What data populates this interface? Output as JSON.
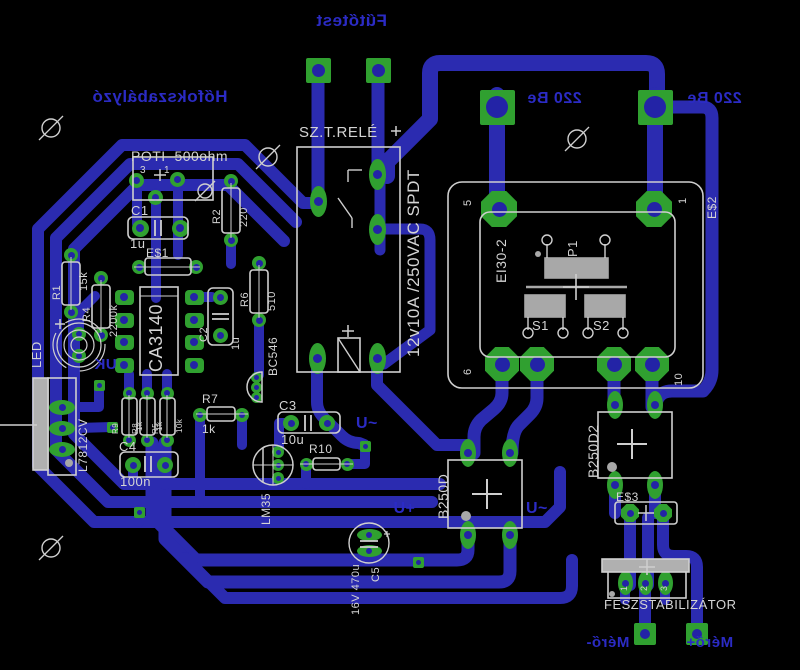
{
  "board": {
    "background": "#000000",
    "trace_color": "#2b2bb0",
    "pad_color": "#30a030",
    "silk_color": "#cfcfcf",
    "copper_text_color": "#2b2bc4"
  },
  "copper_texts": [
    {
      "name": "label-futotest",
      "text": "Fűtőtest",
      "x": 316,
      "y": 12,
      "size": 17,
      "mirrored": true
    },
    {
      "name": "label-hofokszabalyzo",
      "text": "Hőfokszabályzó",
      "x": 92,
      "y": 88,
      "size": 17,
      "mirrored": true
    },
    {
      "name": "label-220be-left",
      "text": "220 Be",
      "x": 527,
      "y": 91,
      "size": 16,
      "mirrored": true
    },
    {
      "name": "label-220be-right",
      "text": "220 Be",
      "x": 687,
      "y": 91,
      "size": 16,
      "mirrored": true
    },
    {
      "name": "label-uk",
      "text": "UK",
      "x": 94,
      "y": 357,
      "size": 15,
      "mirrored": true
    },
    {
      "name": "label-u-ac-top",
      "text": "U~",
      "x": 356,
      "y": 416,
      "size": 16,
      "mirrored": false
    },
    {
      "name": "label-u-plus",
      "text": "+U",
      "x": 393,
      "y": 501,
      "size": 16,
      "mirrored": true
    },
    {
      "name": "label-u-ac-right",
      "text": "U~",
      "x": 526,
      "y": 501,
      "size": 16,
      "mirrored": false
    },
    {
      "name": "label-mero-minus",
      "text": "Mérő-",
      "x": 586,
      "y": 635,
      "size": 15,
      "mirrored": true
    },
    {
      "name": "label-mero-plus",
      "text": "Mérő+",
      "x": 686,
      "y": 635,
      "size": 15,
      "mirrored": true
    }
  ],
  "silk_texts": [
    {
      "name": "label-relay",
      "text": "SZ.T.RELÉ",
      "x": 299,
      "y": 125,
      "size": 15,
      "rot": 0
    },
    {
      "name": "label-relay-rating",
      "text": "12v10A /250VAC SPDT",
      "x": 405,
      "y": 357,
      "size": 17,
      "rot": -90
    },
    {
      "name": "label-poti",
      "text": "POTI  500ohm",
      "x": 131,
      "y": 149,
      "size": 14,
      "rot": 0
    },
    {
      "name": "label-c1",
      "text": "C1",
      "x": 131,
      "y": 204,
      "size": 13,
      "rot": 0
    },
    {
      "name": "value-c1",
      "text": "1u",
      "x": 130,
      "y": 237,
      "size": 13,
      "rot": 0
    },
    {
      "name": "label-e1",
      "text": "E$1",
      "x": 146,
      "y": 247,
      "size": 12,
      "rot": 0
    },
    {
      "name": "label-r2",
      "text": "R2",
      "x": 212,
      "y": 224,
      "size": 11,
      "rot": -90
    },
    {
      "name": "value-r2",
      "text": "220",
      "x": 239,
      "y": 227,
      "size": 11,
      "rot": -90
    },
    {
      "name": "label-r1",
      "text": "R1",
      "x": 52,
      "y": 300,
      "size": 11,
      "rot": -90
    },
    {
      "name": "value-r1",
      "text": "15k",
      "x": 79,
      "y": 291,
      "size": 11,
      "rot": -90
    },
    {
      "name": "label-r4",
      "text": "R4",
      "x": 82,
      "y": 322,
      "size": 11,
      "rot": -90
    },
    {
      "name": "value-r4",
      "text": "2200k",
      "x": 109,
      "y": 337,
      "size": 11,
      "rot": -90
    },
    {
      "name": "label-ic",
      "text": "CA3140",
      "x": 147,
      "y": 372,
      "size": 18,
      "rot": -90
    },
    {
      "name": "label-c2",
      "text": "C2",
      "x": 199,
      "y": 342,
      "size": 11,
      "rot": -90
    },
    {
      "name": "value-c2",
      "text": "1u",
      "x": 231,
      "y": 350,
      "size": 11,
      "rot": -90
    },
    {
      "name": "label-r6",
      "text": "R6",
      "x": 240,
      "y": 307,
      "size": 11,
      "rot": -90
    },
    {
      "name": "value-r6",
      "text": "510",
      "x": 267,
      "y": 311,
      "size": 11,
      "rot": -90
    },
    {
      "name": "label-bc546",
      "text": "BC546",
      "x": 267,
      "y": 376,
      "size": 12,
      "rot": -90
    },
    {
      "name": "label-led",
      "text": "LED",
      "x": 30,
      "y": 368,
      "size": 13,
      "rot": -90
    },
    {
      "name": "label-7812",
      "text": "L7812CV",
      "x": 77,
      "y": 472,
      "size": 12,
      "rot": -90
    },
    {
      "name": "label-r9",
      "text": "R9",
      "x": 112,
      "y": 434,
      "size": 8,
      "rot": -90
    },
    {
      "name": "value-r9",
      "text": "1k",
      "x": 136,
      "y": 431,
      "size": 8,
      "rot": -90
    },
    {
      "name": "label-r8",
      "text": "R8",
      "x": 132,
      "y": 434,
      "size": 8,
      "rot": -90
    },
    {
      "name": "value-r8",
      "text": "1k",
      "x": 156,
      "y": 431,
      "size": 8,
      "rot": -90
    },
    {
      "name": "label-r5",
      "text": "R5",
      "x": 152,
      "y": 434,
      "size": 8,
      "rot": -90
    },
    {
      "name": "value-r5",
      "text": "10k",
      "x": 176,
      "y": 433,
      "size": 8,
      "rot": -90
    },
    {
      "name": "label-r7",
      "text": "R7",
      "x": 202,
      "y": 393,
      "size": 12,
      "rot": 0
    },
    {
      "name": "value-r7",
      "text": "1k",
      "x": 202,
      "y": 423,
      "size": 12,
      "rot": 0
    },
    {
      "name": "label-c4",
      "text": "C4",
      "x": 119,
      "y": 440,
      "size": 13,
      "rot": 0
    },
    {
      "name": "value-c4",
      "text": "100n",
      "x": 120,
      "y": 475,
      "size": 13,
      "rot": 0
    },
    {
      "name": "label-c3",
      "text": "C3",
      "x": 279,
      "y": 399,
      "size": 13,
      "rot": 0
    },
    {
      "name": "value-c3",
      "text": "10u",
      "x": 281,
      "y": 433,
      "size": 13,
      "rot": 0
    },
    {
      "name": "label-r10",
      "text": "R10",
      "x": 309,
      "y": 443,
      "size": 12,
      "rot": 0
    },
    {
      "name": "label-lm35",
      "text": "LM35",
      "x": 260,
      "y": 525,
      "size": 12,
      "rot": -90
    },
    {
      "name": "value-c5",
      "text": "16V 470u",
      "x": 351,
      "y": 615,
      "size": 11,
      "rot": -90
    },
    {
      "name": "label-c5",
      "text": "C5",
      "x": 371,
      "y": 582,
      "size": 11,
      "rot": -90
    },
    {
      "name": "label-b250d",
      "text": "B250D",
      "x": 436,
      "y": 519,
      "size": 14,
      "rot": -90
    },
    {
      "name": "label-b250d2",
      "text": "B250D2",
      "x": 586,
      "y": 478,
      "size": 14,
      "rot": -90
    },
    {
      "name": "label-e3",
      "text": "E$3",
      "x": 616,
      "y": 491,
      "size": 12,
      "rot": 0
    },
    {
      "name": "label-feszstab",
      "text": "FESZSTABILIZÁTOR",
      "x": 604,
      "y": 598,
      "size": 13,
      "rot": 0
    },
    {
      "name": "label-ei30",
      "text": "EI30-2",
      "x": 494,
      "y": 283,
      "size": 14,
      "rot": -90
    },
    {
      "name": "label-p1",
      "text": "P1",
      "x": 566,
      "y": 257,
      "size": 13,
      "rot": -90
    },
    {
      "name": "label-s1",
      "text": "S1",
      "x": 532,
      "y": 319,
      "size": 13,
      "rot": 0
    },
    {
      "name": "label-s2",
      "text": "S2",
      "x": 593,
      "y": 319,
      "size": 13,
      "rot": 0
    },
    {
      "name": "label-e2",
      "text": "E$2",
      "x": 706,
      "y": 219,
      "size": 12,
      "rot": -90
    },
    {
      "name": "pin-5",
      "text": "5",
      "x": 463,
      "y": 206,
      "size": 11,
      "rot": -90
    },
    {
      "name": "pin-1",
      "text": "1",
      "x": 678,
      "y": 204,
      "size": 11,
      "rot": -90
    },
    {
      "name": "pin-6",
      "text": "6",
      "x": 463,
      "y": 375,
      "size": 11,
      "rot": -90
    },
    {
      "name": "pin-10",
      "text": "10",
      "x": 674,
      "y": 386,
      "size": 11,
      "rot": -90
    },
    {
      "name": "fesz-pin1",
      "text": "1",
      "x": 620,
      "y": 591,
      "size": 9,
      "rot": -90
    },
    {
      "name": "fesz-pin2",
      "text": "2",
      "x": 640,
      "y": 591,
      "size": 9,
      "rot": -90
    },
    {
      "name": "fesz-pin3",
      "text": "3",
      "x": 660,
      "y": 591,
      "size": 9,
      "rot": -90
    },
    {
      "name": "poti-pin3",
      "text": "3",
      "x": 140,
      "y": 166,
      "size": 10,
      "rot": 0
    },
    {
      "name": "poti-pin1",
      "text": "1",
      "x": 164,
      "y": 166,
      "size": 10,
      "rot": 0
    }
  ]
}
